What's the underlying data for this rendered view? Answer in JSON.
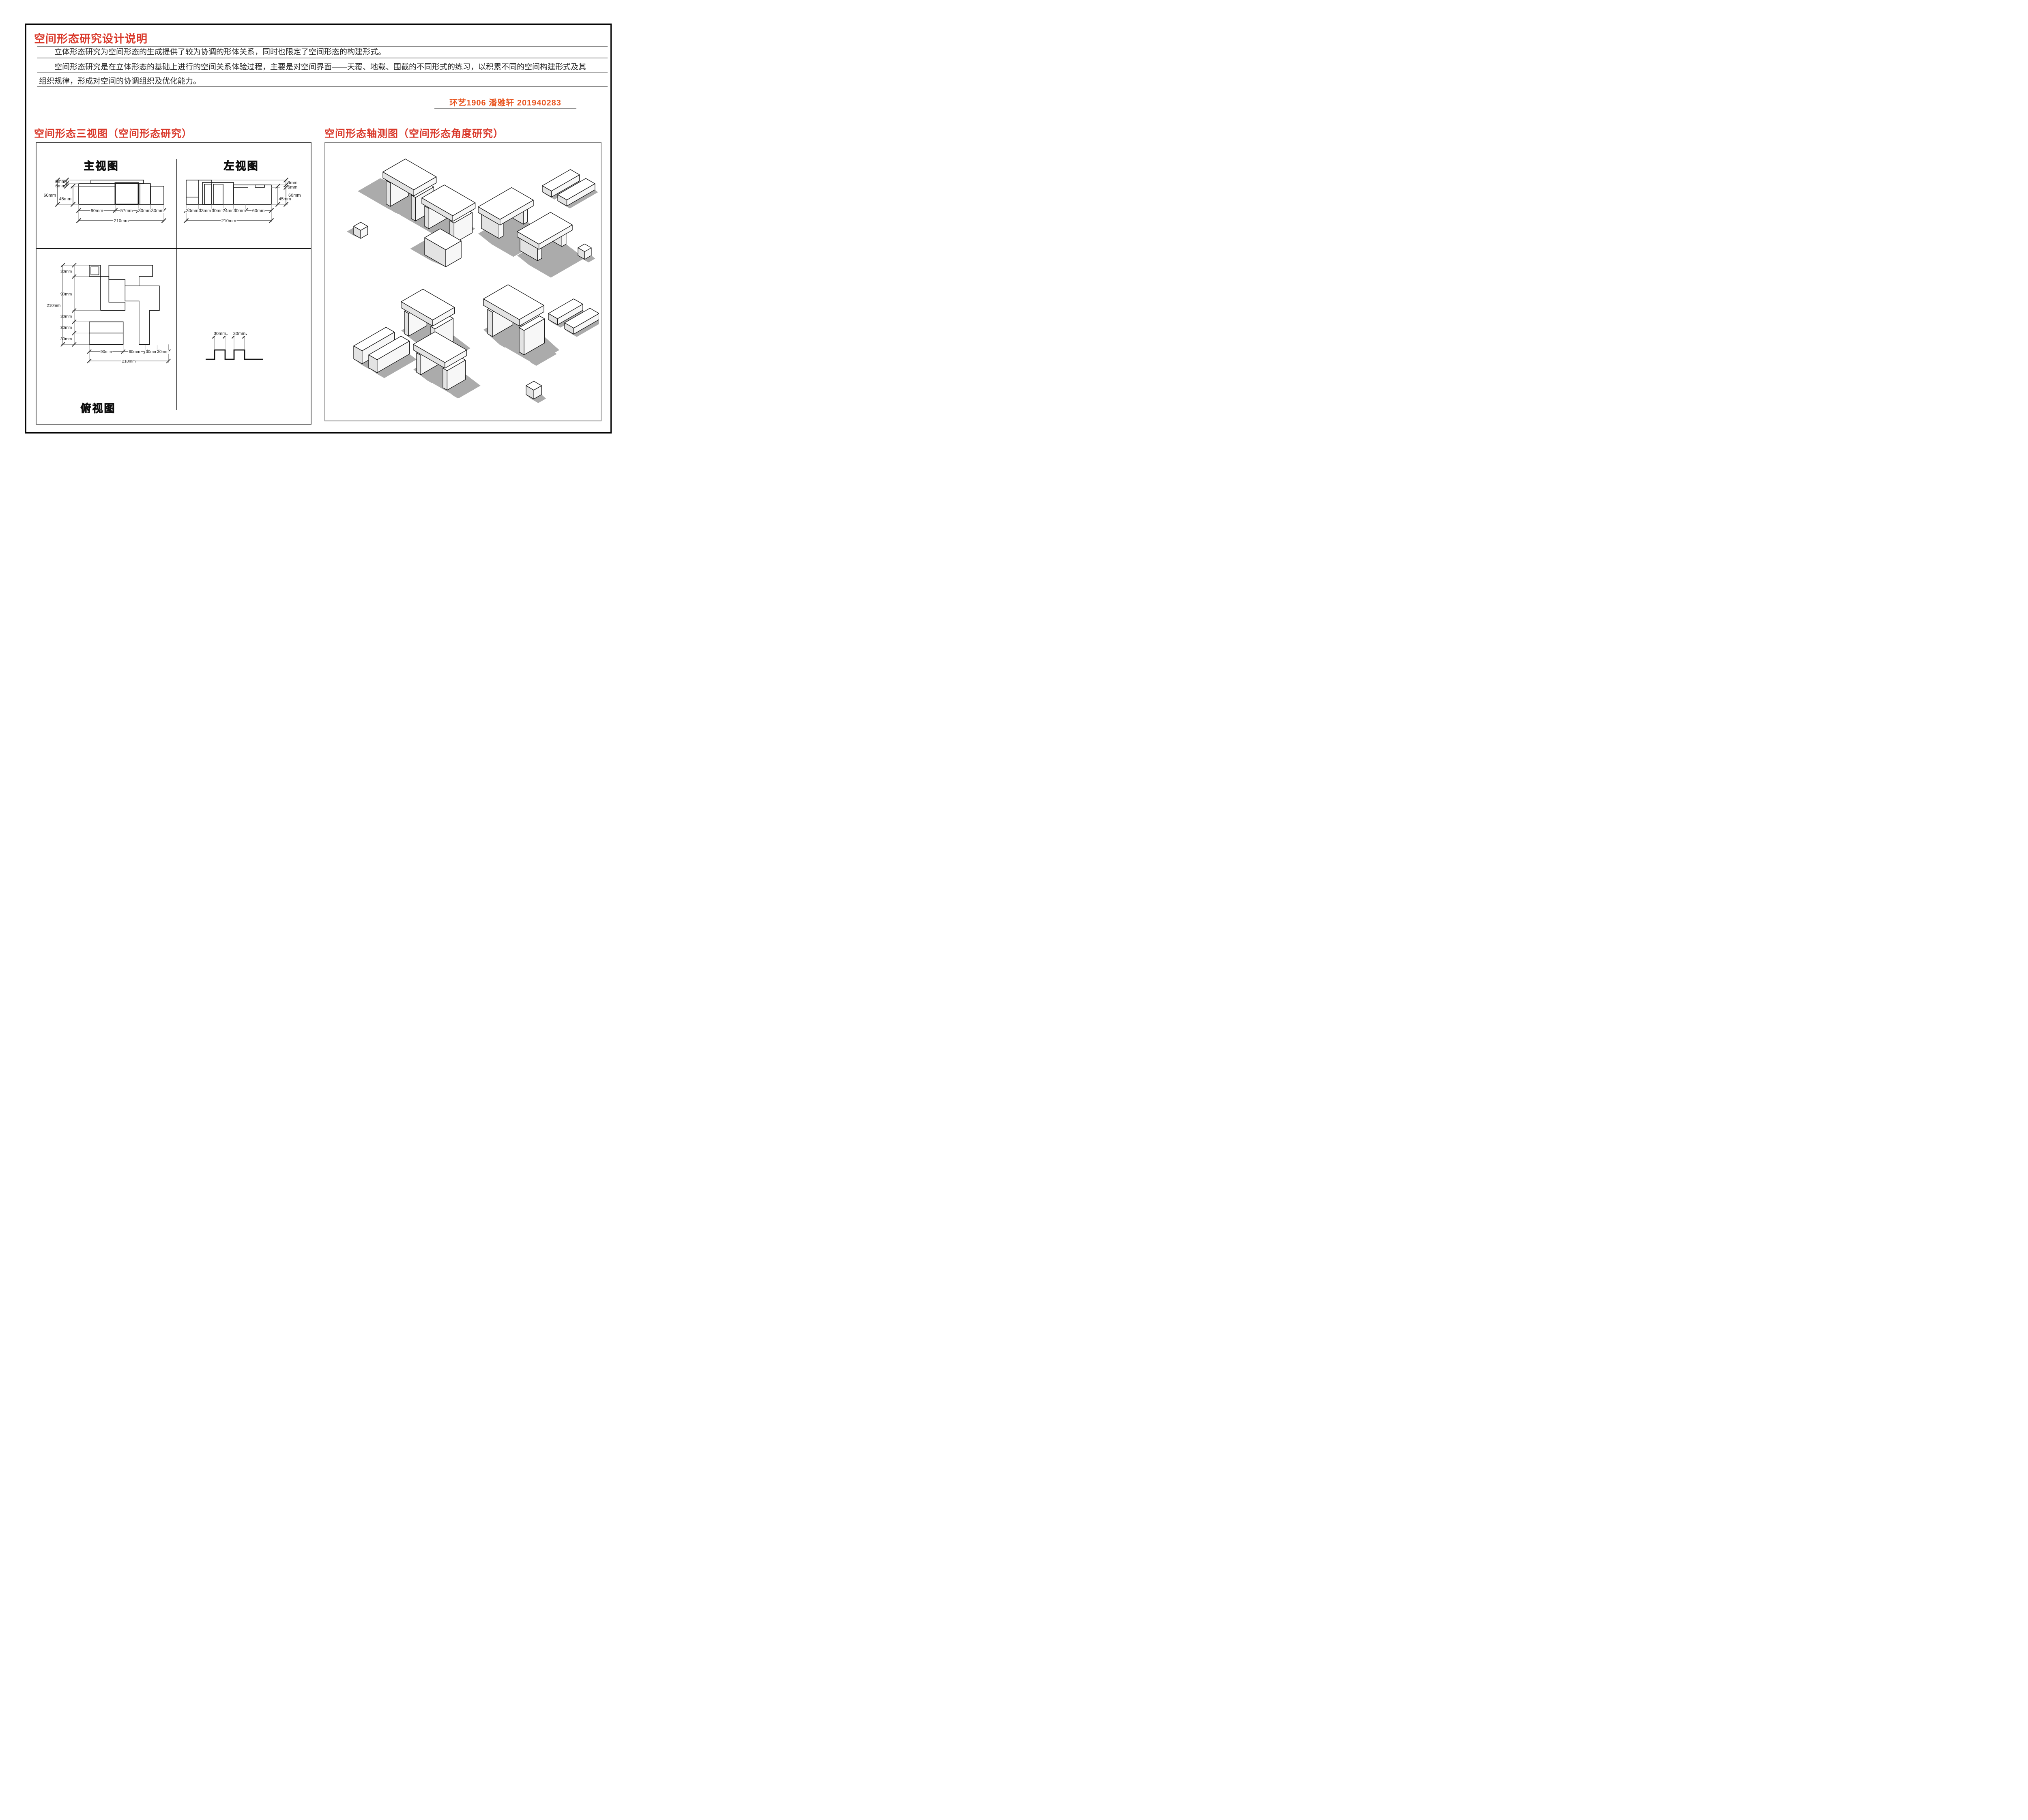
{
  "doc": {
    "title": "空间形态研究设计说明",
    "paragraph1": "立体形态研究为空间形态的生成提供了较为协调的形体关系，同时也限定了空间形态的构建形式。",
    "paragraph2": "空间形态研究是在立体形态的基础上进行的空间关系体验过程，主要是对空间界面——天覆、地载、围截的不同形式的练习，以积累不同的空间构建形式及其组织规律，形成对空间的协调组织及优化能力。",
    "student_info": "环艺1906  潘雅轩   201940283"
  },
  "sections": {
    "left_title": "空间形态三视图（空间形态研究）",
    "right_title": "空间形态轴测图（空间形态角度研究）"
  },
  "colors": {
    "heading_red": "#d9382a",
    "student_orange": "#e85520",
    "rule_gray": "#8f8f8f",
    "shadow_gray": "#ababab"
  },
  "views": {
    "front": {
      "title": "主视图",
      "left_dims": [
        "9mm",
        "6mm",
        "60mm",
        "45mm"
      ],
      "bottom_dims": [
        "90mm",
        "57mm",
        "30mm",
        "30mm"
      ],
      "total": "210mm"
    },
    "left": {
      "title": "左视图",
      "right_dims": [
        "9mm",
        "6mm",
        "60mm",
        "45mm"
      ],
      "bottom_dims": [
        "30mm",
        "33mm",
        "30mm",
        "24mm",
        "30mm",
        "60mm"
      ],
      "total": "210mm"
    },
    "top": {
      "title": "俯视图",
      "left_dims": [
        "30mm",
        "90mm",
        "30mm",
        "30mm",
        "30mm"
      ],
      "left_total": "210mm",
      "bottom_dims": [
        "90mm",
        "60mm",
        "30mm",
        "30mm"
      ],
      "total": "210mm"
    },
    "profile": {
      "dims": [
        "30mm",
        "30mm"
      ]
    }
  }
}
